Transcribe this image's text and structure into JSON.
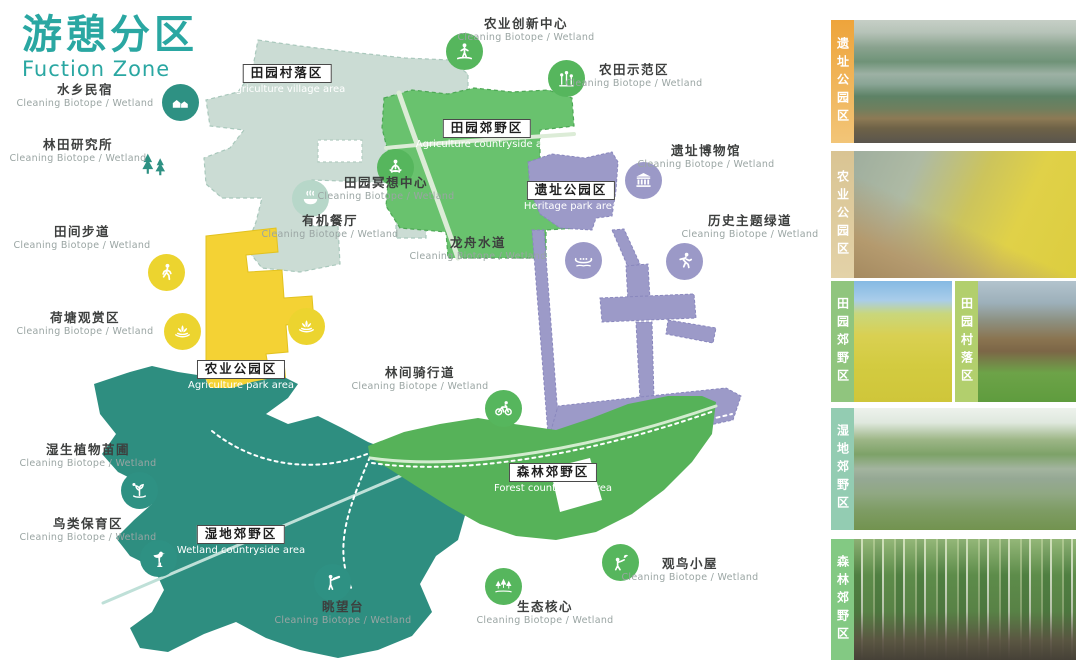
{
  "title": {
    "zh": "游憩分区",
    "en": "Fuction Zone"
  },
  "colors": {
    "title": "#2aa7a2",
    "zh_text": "#3d3f3e",
    "sub_text": "#9aa5a3"
  },
  "poi_sub_label": "Cleaning  Biotope / Wetland",
  "zones": [
    {
      "id": "village",
      "zh": "田园村落区",
      "en": "Agriculture village area",
      "color": "#cbdcd4",
      "label_x": 287,
      "label_y": 62
    },
    {
      "id": "countryside",
      "zh": "田园郊野区",
      "en": "Agriculture countryside area",
      "color": "#69c26e",
      "label_x": 487,
      "label_y": 117
    },
    {
      "id": "heritage",
      "zh": "遗址公园区",
      "en": "Heritage park area",
      "color": "#9c9ac8",
      "label_x": 571,
      "label_y": 179
    },
    {
      "id": "agripark",
      "zh": "农业公园区",
      "en": "Agriculture park area",
      "color": "#f4d234",
      "label_x": 241,
      "label_y": 358
    },
    {
      "id": "wetland",
      "zh": "湿地郊野区",
      "en": "Wetland countryside area",
      "color": "#2e8e80",
      "label_x": 241,
      "label_y": 523
    },
    {
      "id": "forest",
      "zh": "森林郊野区",
      "en": "Forest countryside area",
      "color": "#56b259",
      "label_x": 553,
      "label_y": 461
    }
  ],
  "pois": [
    {
      "id": "shuixiang-minsu",
      "zh": "水乡民宿",
      "icon": "house",
      "color": "#2e9183",
      "icon_x": 180,
      "icon_y": 102,
      "label_x": 85,
      "label_y": 83
    },
    {
      "id": "lintian-yanjiusuo",
      "zh": "林田研究所",
      "icon": "trees",
      "color": "none",
      "icon_x": 155,
      "icon_y": 166,
      "label_x": 78,
      "label_y": 138
    },
    {
      "id": "tianjian-budao",
      "zh": "田间步道",
      "icon": "walker",
      "color": "#ecd42f",
      "icon_x": 166,
      "icon_y": 272,
      "label_x": 82,
      "label_y": 225
    },
    {
      "id": "hetang-guanshangqu",
      "zh": "荷塘观赏区",
      "icon": "lotus",
      "color": "#ecd42f",
      "icon_x": 182,
      "icon_y": 331,
      "label_x": 85,
      "label_y": 311
    },
    {
      "id": "shisheng-miaopu",
      "zh": "湿生植物苗圃",
      "icon": "plant",
      "color": "#2e9183",
      "icon_x": 139,
      "icon_y": 490,
      "label_x": 88,
      "label_y": 443
    },
    {
      "id": "niaolei-baoyuqu",
      "zh": "鸟类保育区",
      "icon": "heron",
      "color": "#2e9183",
      "icon_x": 158,
      "icon_y": 558,
      "label_x": 88,
      "label_y": 517
    },
    {
      "id": "nongye-chuangxin",
      "zh": "农业创新中心",
      "icon": "farmer",
      "color": "#56b65d",
      "icon_x": 464,
      "icon_y": 51,
      "label_x": 526,
      "label_y": 17
    },
    {
      "id": "nongtian-shifanqu",
      "zh": "农田示范区",
      "icon": "flowers",
      "color": "#56b65d",
      "icon_x": 566,
      "icon_y": 78,
      "label_x": 634,
      "label_y": 63
    },
    {
      "id": "yizhi-bowuguan",
      "zh": "遗址博物馆",
      "icon": "museum",
      "color": "#9b99c7",
      "icon_x": 643,
      "icon_y": 180,
      "label_x": 706,
      "label_y": 144
    },
    {
      "id": "lishi-zhuti-ludao",
      "zh": "历史主题绿道",
      "icon": "runner",
      "color": "#9b99c7",
      "icon_x": 684,
      "icon_y": 261,
      "label_x": 750,
      "label_y": 214
    },
    {
      "id": "longzhou-shuidao",
      "zh": "龙舟水道",
      "icon": "boat",
      "color": "#9b99c7",
      "icon_x": 583,
      "icon_y": 260,
      "label_x": 478,
      "label_y": 236
    },
    {
      "id": "mingxiang-zhongxin",
      "zh": "田园冥想中心",
      "icon": "meditate",
      "color": "#56b65d",
      "icon_x": 395,
      "icon_y": 167,
      "label_x": 386,
      "label_y": 176
    },
    {
      "id": "youji-canting",
      "zh": "有机餐厅",
      "icon": "bowl",
      "color": "#b7d7c9",
      "icon_x": 310,
      "icon_y": 198,
      "label_x": 330,
      "label_y": 214
    },
    {
      "id": "linjian-qixingdao",
      "zh": "林间骑行道",
      "icon": "bike",
      "color": "#56b65d",
      "icon_x": 503,
      "icon_y": 408,
      "label_x": 420,
      "label_y": 366
    },
    {
      "id": "tiaowangtai",
      "zh": "眺望台",
      "icon": "scope",
      "color": "#2e9183",
      "icon_x": 332,
      "icon_y": 582,
      "label_x": 343,
      "label_y": 600
    },
    {
      "id": "shengtai-hexin",
      "zh": "生态核心",
      "icon": "pines",
      "color": "#56b65d",
      "icon_x": 503,
      "icon_y": 586,
      "label_x": 545,
      "label_y": 600
    },
    {
      "id": "guanniao-xiaowu",
      "zh": "观鸟小屋",
      "icon": "birdwatch",
      "color": "#56b65d",
      "icon_x": 620,
      "icon_y": 562,
      "label_x": 690,
      "label_y": 557
    }
  ],
  "markers": [
    {
      "id": "hetang-map-marker",
      "icon": "lotus",
      "color": "#ecd42f",
      "icon_x": 306,
      "icon_y": 326
    }
  ],
  "sidebar": {
    "rows": [
      {
        "top": 20,
        "height": 123,
        "cards": [
          {
            "zh": "遗址公园区",
            "label_colors": [
              "#eea43b",
              "#f2c578"
            ],
            "photo": "heritage-aerial"
          }
        ]
      },
      {
        "top": 151,
        "height": 127,
        "cards": [
          {
            "zh": "农业公园区",
            "label_colors": [
              "#d9c493",
              "#e3d2a8"
            ],
            "photo": "boardwalk-rapeseed"
          }
        ]
      },
      {
        "top": 281,
        "height": 121,
        "cards": [
          {
            "zh": "田园郊野区",
            "label_colors": [
              "#90c57e",
              "#90c57e"
            ],
            "photo": "field-path"
          },
          {
            "zh": "田园村落区",
            "label_colors": [
              "#b2cf6d",
              "#b2cf6d"
            ],
            "photo": "village-houses"
          }
        ]
      },
      {
        "top": 408,
        "height": 122,
        "cards": [
          {
            "zh": "湿地郊野区",
            "label_colors": [
              "#93ccb2",
              "#93ccb2"
            ],
            "photo": "wetland-lake"
          }
        ]
      },
      {
        "top": 539,
        "height": 121,
        "cards": [
          {
            "zh": "森林郊野区",
            "label_colors": [
              "#83c983",
              "#83c983"
            ],
            "photo": "forest-path"
          }
        ]
      }
    ]
  }
}
